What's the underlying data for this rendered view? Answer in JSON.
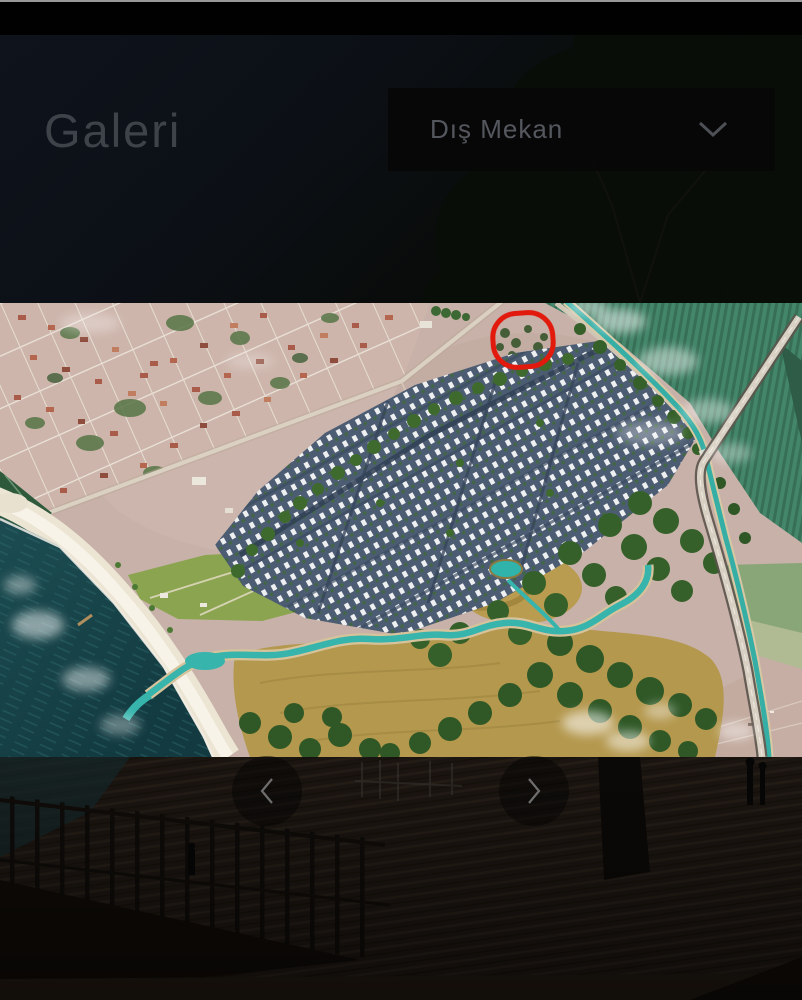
{
  "header": {
    "title": "Galeri",
    "filter": {
      "selected_option": "Dış Mekan",
      "icon": "chevron-down-icon"
    }
  },
  "carousel": {
    "slide": {
      "name": "aerial-masterplan-photo",
      "annotation": {
        "shape": "red-circle",
        "color": "#e2190d"
      }
    },
    "controls": {
      "prev_icon": "chevron-left-icon",
      "next_icon": "chevron-right-icon"
    }
  },
  "colors": {
    "page_background": "#000000",
    "sea": "#1c4d52",
    "canal_water": "#35aea6",
    "field_green": "#43866a",
    "marsh_gold": "#b4984e",
    "town_ground": "#c7b1a8",
    "annotation_red": "#e2190d"
  }
}
